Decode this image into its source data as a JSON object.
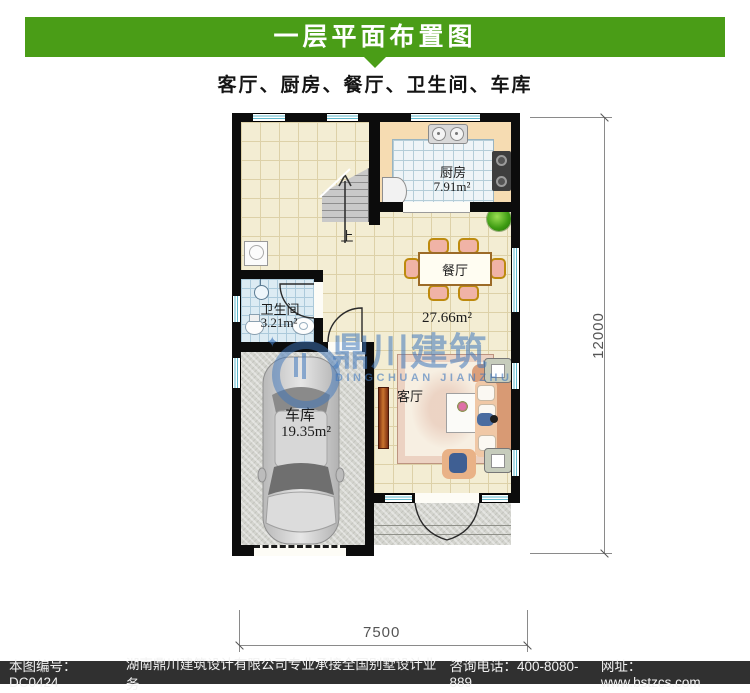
{
  "colors": {
    "header_green": "#4a9d17",
    "footer_bg": "#303030",
    "watermark_blue": "#3e76bc"
  },
  "header": {
    "title": "一层平面布置图",
    "subtitle": "客厅、厨房、餐厅、卫生间、车库"
  },
  "plan": {
    "rooms": {
      "kitchen": {
        "name": "厨房",
        "area": "7.91m²"
      },
      "dining": {
        "name": "餐厅"
      },
      "living": {
        "name": "客厅"
      },
      "bathroom": {
        "name": "卫生间",
        "area": "3.21m²"
      },
      "garage": {
        "name": "车库",
        "area": "19.35m²"
      }
    },
    "open_area_label": "27.66m²",
    "stairs_up": "上",
    "dim_width": "7500",
    "dim_height": "12000"
  },
  "watermark": {
    "cn": "鼎川建筑",
    "en": "DINGCHUAN JIANZHU"
  },
  "footer": {
    "sheet_no": "本图编号：DC0424",
    "company": "湖南鼎川建筑设计有限公司专业承接全国别墅设计业务",
    "phone": "咨询电话：400-8080-889",
    "website": "网址：www.bstzcs.com"
  }
}
